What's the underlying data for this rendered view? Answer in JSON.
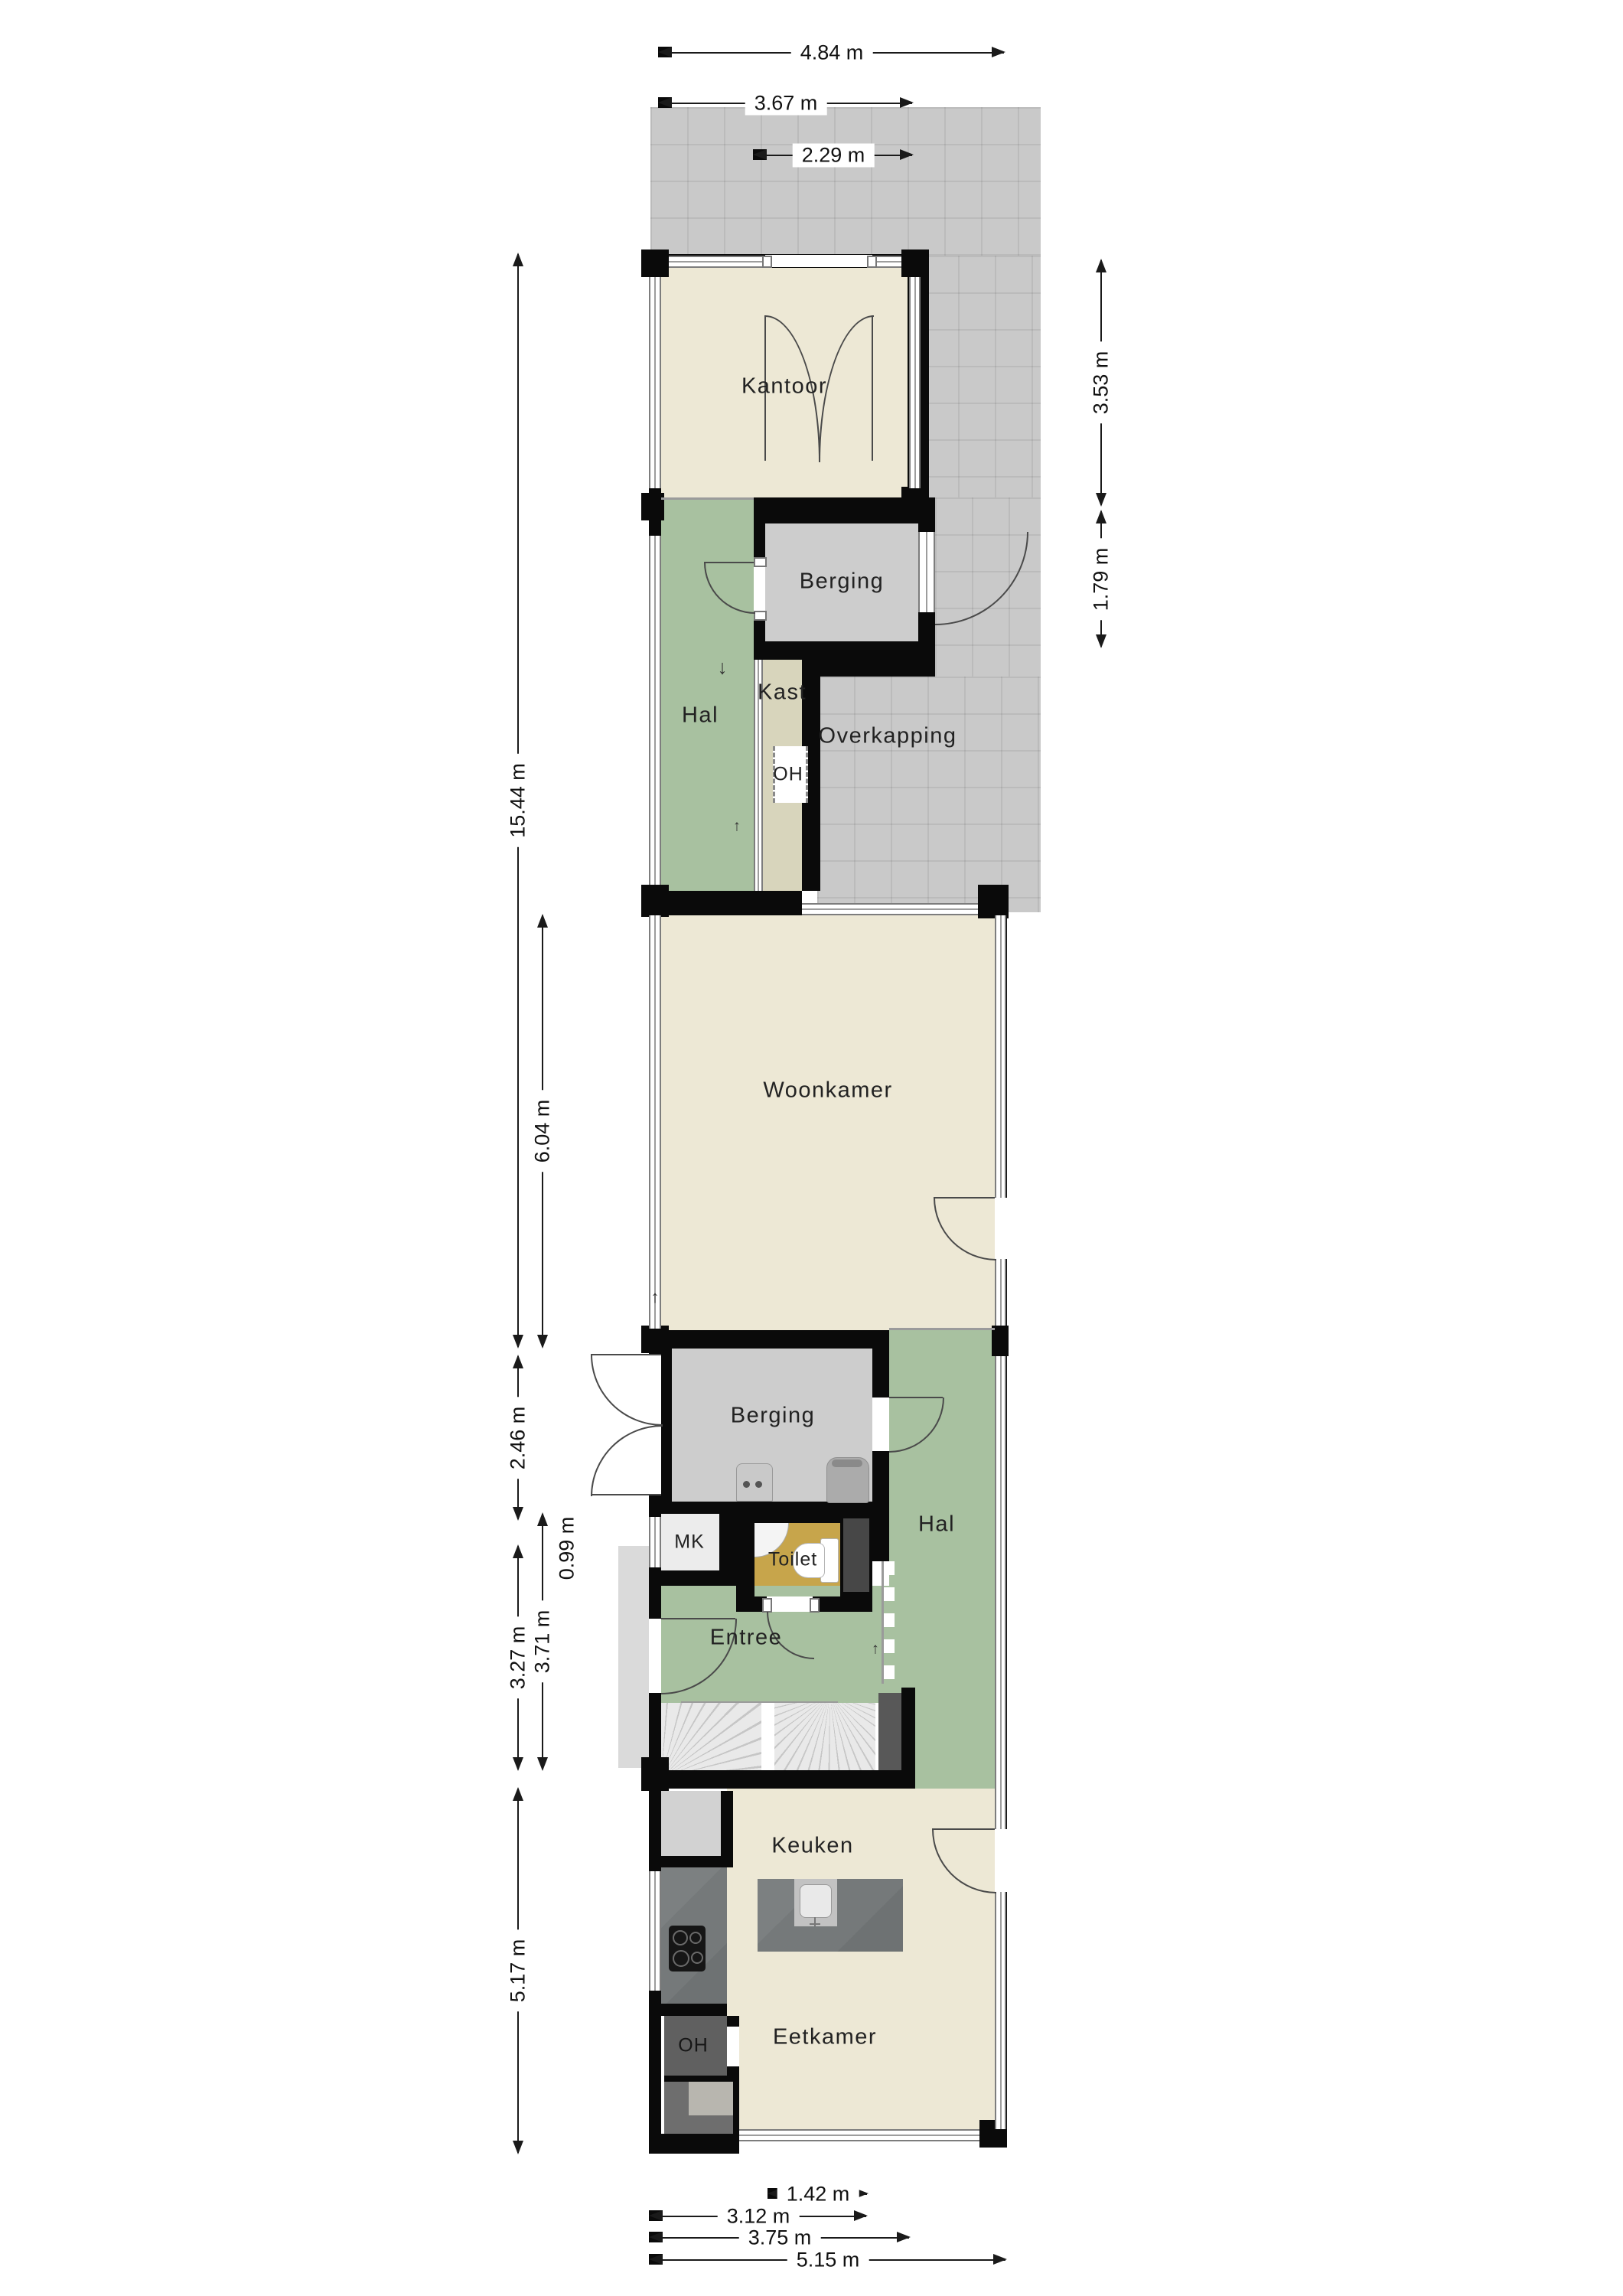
{
  "plan": {
    "title": "floor-plan",
    "rooms": {
      "kantoor": {
        "label": "Kantoor",
        "color": "#ede8d5"
      },
      "berging_top": {
        "label": "Berging",
        "color": "#cdcdcd"
      },
      "hal_top": {
        "label": "Hal",
        "color": "#a8c1a0"
      },
      "kast": {
        "label": "Kast",
        "color": "#d8d5bc"
      },
      "oh_top": {
        "label": "OH",
        "color": "#ffffff"
      },
      "overkapping": {
        "label": "Overkapping",
        "color": "#c9c9c9"
      },
      "woonkamer": {
        "label": "Woonkamer",
        "color": "#ede8d5"
      },
      "berging_mid": {
        "label": "Berging",
        "color": "#cdcdcd"
      },
      "hal_mid": {
        "label": "Hal",
        "color": "#a8c1a0"
      },
      "mk": {
        "label": "MK",
        "color": "#ececec"
      },
      "toilet": {
        "label": "Toilet",
        "color": "#c7a54b"
      },
      "entree": {
        "label": "Entree",
        "color": "#a8c1a0"
      },
      "keuken": {
        "label": "Keuken",
        "color": "#ede8d5"
      },
      "eetkamer": {
        "label": "Eetkamer",
        "color": "#ede8d5"
      },
      "oh_bottom": {
        "label": "OH",
        "color": "#606060"
      }
    },
    "dimensions": {
      "top": [
        {
          "label": "4.84 m"
        },
        {
          "label": "3.67 m"
        },
        {
          "label": "2.29 m"
        }
      ],
      "left": [
        {
          "label": "15.44 m"
        },
        {
          "label": "6.04 m"
        },
        {
          "label": "2.46 m"
        },
        {
          "label": "0.99 m"
        },
        {
          "label": "3.27 m"
        },
        {
          "label": "3.71 m"
        },
        {
          "label": "5.17 m"
        }
      ],
      "right": [
        {
          "label": "3.53 m"
        },
        {
          "label": "1.79 m"
        }
      ],
      "bottom": [
        {
          "label": "1.42 m"
        },
        {
          "label": "3.12 m"
        },
        {
          "label": "3.75 m"
        },
        {
          "label": "5.15 m"
        }
      ]
    },
    "markers": {
      "down_arrow": "↓",
      "up_arrow": "↑"
    },
    "colors": {
      "wall": "#0a0a0a",
      "tiles": "#c9c9c9",
      "cream": "#ede8d5",
      "green": "#a8c1a0",
      "gray_room": "#cdcdcd",
      "kast": "#d8d5bc",
      "toilet": "#c7a54b",
      "concrete": "#75797a",
      "dark_room": "#606060",
      "stairs": "#e3e3e3"
    }
  }
}
